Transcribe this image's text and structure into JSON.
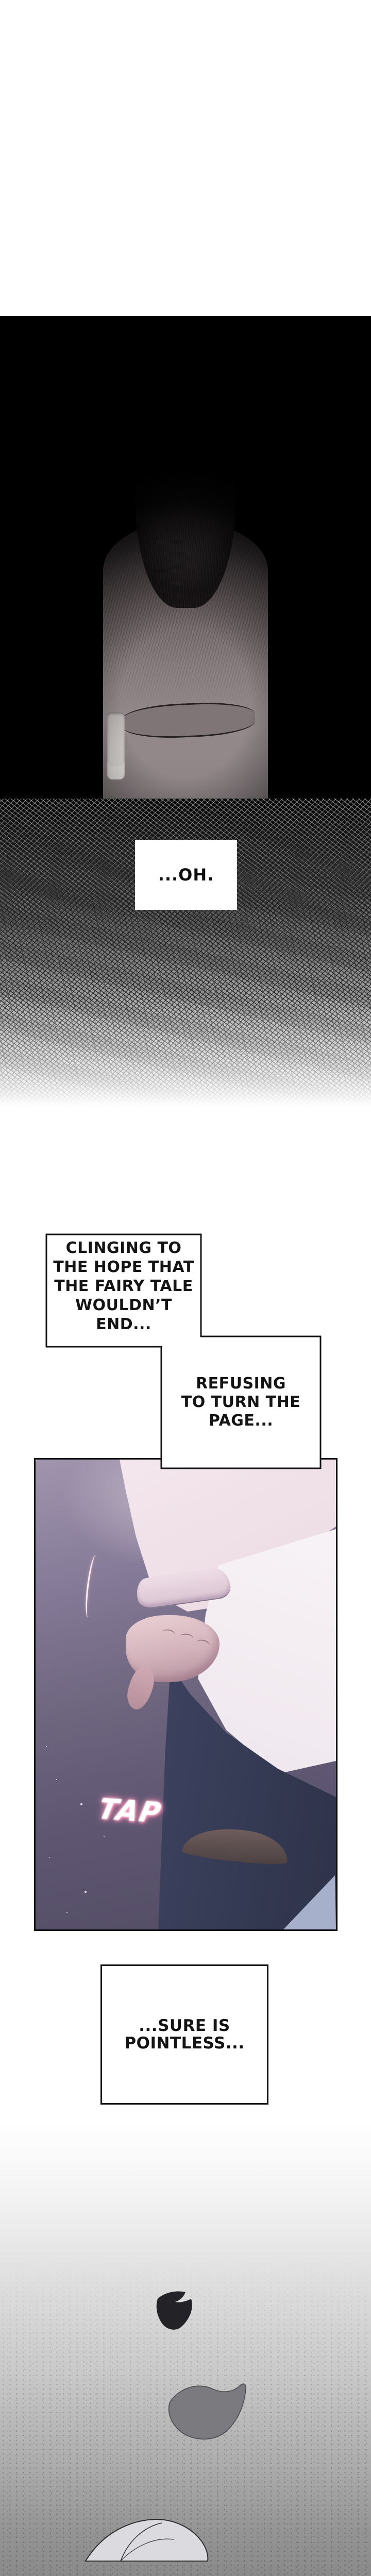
{
  "comic": {
    "speech_boxes": {
      "oh": {
        "text": "...OH."
      },
      "clinging": {
        "lines": [
          "CLINGING TO",
          "THE HOPE THAT",
          "THE FAIRY TALE",
          "WOULDN’T END..."
        ]
      },
      "refusing": {
        "lines": [
          "REFUSING",
          "TO TURN THE",
          "PAGE..."
        ]
      },
      "pointless": {
        "lines": [
          "...SURE IS",
          "POINTLESS..."
        ]
      }
    },
    "sfx": {
      "tap": "TAP"
    },
    "colors": {
      "page_bg": "#ffffff",
      "panel_black": "#000000",
      "panel_purple": "#6b6278",
      "sleeve_pink": "#eddce4",
      "bag_white": "#f7f3f5",
      "pants_navy": "#3a405a",
      "bag_blue": "#aeb8d0",
      "tap_glow": "#ff8fb4",
      "petal_dark": "#232327",
      "petal_mid": "#7b7b80",
      "petal_light": "#dadade",
      "ground_gray": "#8a8a8a"
    }
  }
}
